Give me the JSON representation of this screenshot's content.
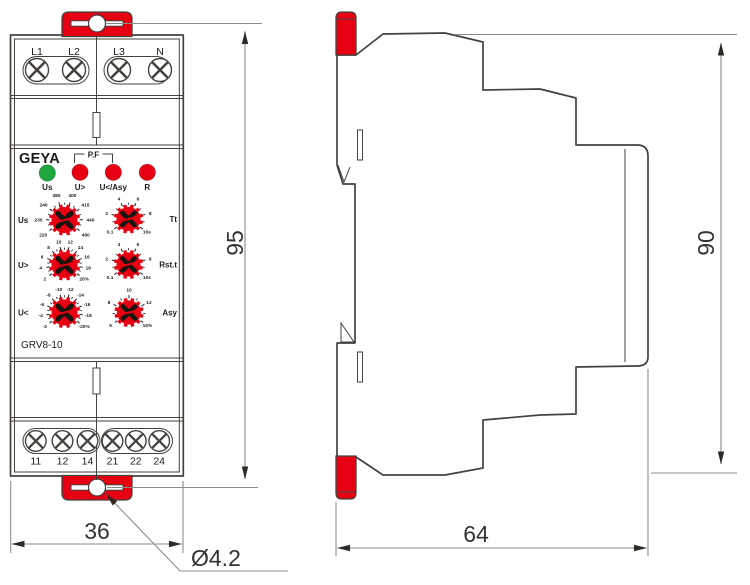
{
  "front_view": {
    "brand": "GEYA",
    "model": "GRV8-10",
    "pf_label": "P.F",
    "top_terminals": [
      "L1",
      "L2",
      "L3",
      "N"
    ],
    "bottom_terminals": [
      "11",
      "12",
      "14",
      "21",
      "22",
      "24"
    ],
    "leds": [
      {
        "label": "Us",
        "color": "#1fa83d"
      },
      {
        "label": "U>",
        "color": "#e60012"
      },
      {
        "label": "U</Asy",
        "color": "#e60012"
      },
      {
        "label": "R",
        "color": "#e60012"
      }
    ],
    "dials": [
      {
        "label": "Us",
        "scale": [
          "220",
          "230",
          "240",
          "380",
          "400",
          "415",
          "440",
          "460"
        ]
      },
      {
        "label": "Tt",
        "scale": [
          "0.1",
          "2",
          "4",
          "6",
          "8",
          "10s"
        ]
      },
      {
        "label": "U>",
        "scale": [
          "2",
          "4",
          "6",
          "8",
          "10",
          "12",
          "14",
          "16",
          "18",
          "20%"
        ]
      },
      {
        "label": "Rst.t",
        "scale": [
          "0.1",
          "2",
          "4",
          "6",
          "8",
          "10s"
        ]
      },
      {
        "label": "U<",
        "scale": [
          "-2",
          "-4",
          "-6",
          "-8",
          "-10",
          "-12",
          "-14",
          "-16",
          "-18",
          "-20%"
        ]
      },
      {
        "label": "Asy",
        "scale": [
          "5",
          "8",
          "10",
          "12",
          "15%"
        ]
      }
    ]
  },
  "dimensions": {
    "height_front": "95",
    "width_front": "36",
    "hole_diameter": "Ø4.2",
    "height_side": "90",
    "depth_side": "64"
  },
  "colors": {
    "accent_red": "#e60012",
    "led_green": "#1fa83d",
    "line": "#45423e",
    "dim_line": "#8b8b89",
    "arrow": "#2e2a26"
  }
}
